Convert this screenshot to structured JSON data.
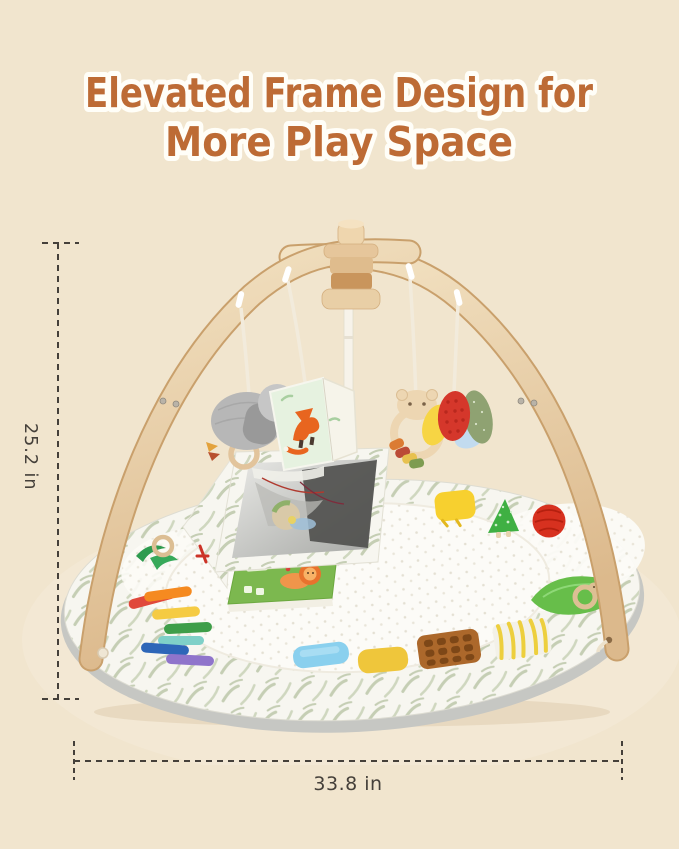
{
  "title": {
    "line1": "Elevated Frame Design for",
    "line2": "More Play Space"
  },
  "dimensions": {
    "height": "25.2 in",
    "width": "33.8 in"
  },
  "palette": {
    "background": "#F1E5CE",
    "title_fill": "#BD6B35",
    "title_stroke": "#FFFEF8",
    "dim_color": "#45403A",
    "wood_light": "#F2E1C2",
    "wood_dark": "#D8B487",
    "mat_leaf_print": "#C5CEB4",
    "mat_center_white": "#FBFAF5",
    "mat_underside_gray": "#C6C7C3"
  },
  "scene": {
    "product": "baby play gym with arched wooden frame over round activity mat",
    "frame_parts": [
      "crossed-wood-arches",
      "wood-hub-knob",
      "center-post",
      "white-hanging-hooks"
    ],
    "hanging_toys": [
      {
        "name": "elephant-plush-rattle",
        "color": "#B7B7B7"
      },
      {
        "name": "fox-cloth-book",
        "color": "#E8651F"
      },
      {
        "name": "bear-wood-teether-ring",
        "color": "#EDD6B2"
      },
      {
        "name": "fabric-leaf-rattle-cluster",
        "colors": [
          "#F7D544",
          "#D5372B",
          "#8FA272",
          "#C2DBEF"
        ]
      }
    ],
    "mat_items": [
      {
        "name": "rainbow-ribbon-tags",
        "colors": [
          "#E0483B",
          "#F58A20",
          "#F5CB43",
          "#3E9E49",
          "#2D66B8",
          "#8F74CB"
        ]
      },
      {
        "name": "mirror-wedge",
        "color": "#D8D8D6"
      },
      {
        "name": "lion-cloth-book",
        "color": "#7CB84F"
      },
      {
        "name": "crinkle-texture-patches",
        "colors": [
          "#8AD0EE",
          "#EFC63B",
          "#AC682B",
          "#EDCF3D"
        ]
      },
      {
        "name": "knit-ball",
        "color": "#D7311F"
      },
      {
        "name": "tree-crinkle-toy",
        "color": "#3FB043"
      },
      {
        "name": "leaf-with-wood-duck-teether",
        "color": "#67BE4A"
      },
      {
        "name": "wood-ring-with-green-ribbon",
        "color": "#2E9B4F"
      }
    ]
  }
}
